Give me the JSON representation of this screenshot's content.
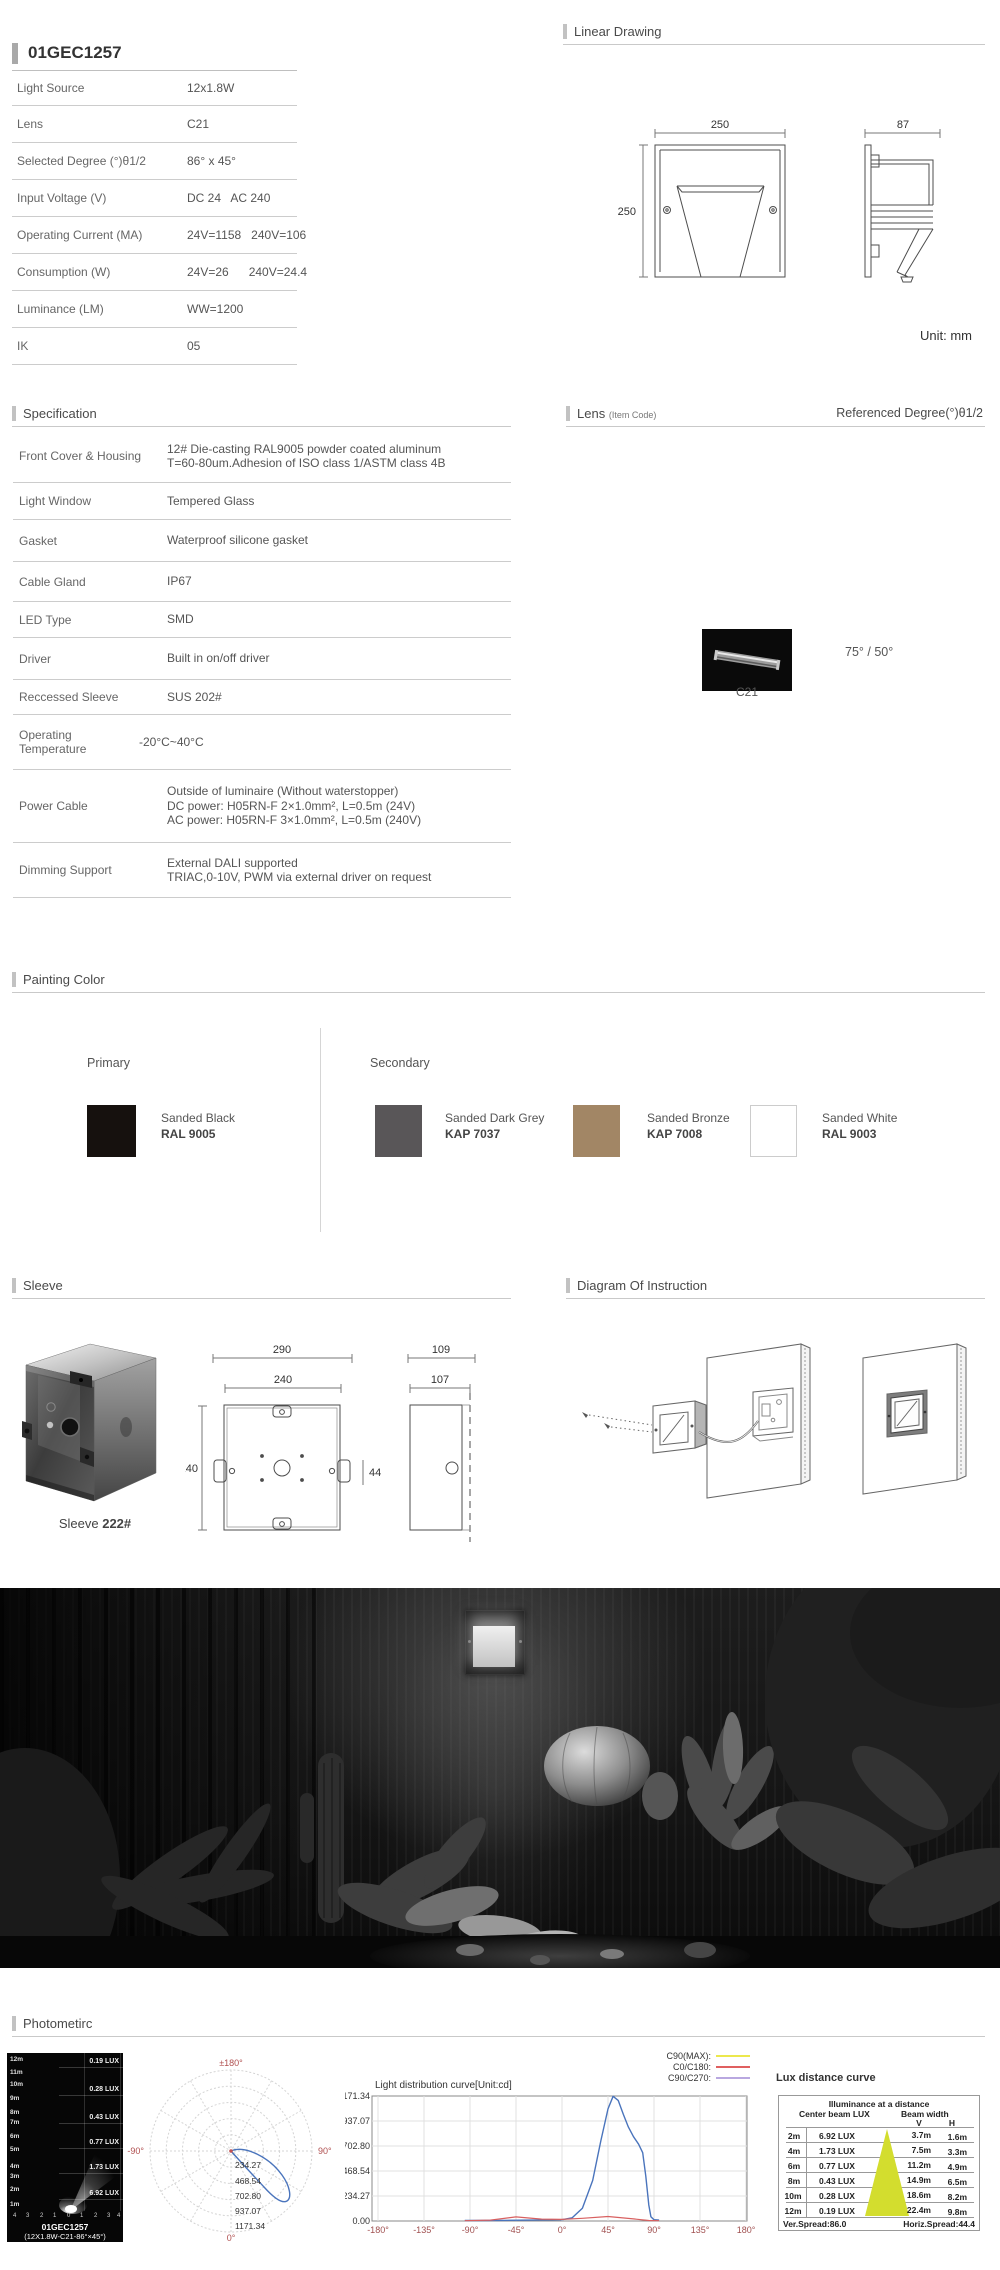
{
  "product": {
    "code": "01GEC1257",
    "rows": [
      {
        "label": "Light Source",
        "value": "12x1.8W"
      },
      {
        "label": "Lens",
        "value": "C21"
      },
      {
        "label": "Selected Degree (°)θ1/2",
        "value": "86° x 45°"
      },
      {
        "label": "Input Voltage (V)",
        "value": "DC 24   AC 240"
      },
      {
        "label": "Operating Current (MA)",
        "value": "24V=1158   240V=106"
      },
      {
        "label": "Consumption (W)",
        "value": "24V=26      240V=24.4"
      },
      {
        "label": "Luminance (LM)",
        "value": "WW=1200"
      },
      {
        "label": "IK",
        "value": "05"
      }
    ]
  },
  "linear_drawing": {
    "title": "Linear Drawing",
    "front_width": "250",
    "front_height": "250",
    "side_width": "87",
    "unit_note": "Unit: mm"
  },
  "specification": {
    "title": "Specification",
    "rows": [
      {
        "label": "Front Cover & Housing",
        "lines": [
          "12# Die-casting RAL9005 powder coated aluminum",
          "T=60-80um.Adhesion of ISO class 1/ASTM class 4B"
        ]
      },
      {
        "label": "Light Window",
        "lines": [
          "Tempered Glass"
        ]
      },
      {
        "label": "Gasket",
        "lines": [
          "Waterproof silicone gasket"
        ]
      },
      {
        "label": "Cable Gland",
        "lines": [
          "IP67"
        ]
      },
      {
        "label": "LED Type",
        "lines": [
          "SMD"
        ]
      },
      {
        "label": "Driver",
        "lines": [
          "Built in on/off driver"
        ]
      },
      {
        "label": "Reccessed Sleeve",
        "lines": [
          "SUS 202#"
        ]
      },
      {
        "label": "Operating Temperature",
        "lines": [
          "-20°C~40°C"
        ]
      },
      {
        "label": "Power Cable",
        "lines": [
          "Outside of luminaire (Without waterstopper)",
          "DC power: H05RN-F 2×1.0mm², L=0.5m (24V)",
          "AC power: H05RN-F 3×1.0mm², L=0.5m (240V)"
        ]
      },
      {
        "label": "Dimming Support",
        "lines": [
          "External DALI supported",
          "TRIAC,0-10V, PWM via external driver on request"
        ]
      }
    ]
  },
  "lens_section": {
    "title": "Lens",
    "subtitle": "(Item Code)",
    "right_title": "Referenced Degree(°)θ1/2",
    "item": "C21",
    "degree": "75° / 50°"
  },
  "painting": {
    "title": "Painting Color",
    "primary_label": "Primary",
    "secondary_label": "Secondary",
    "swatches": [
      {
        "name": "Sanded Black",
        "code": "RAL 9005",
        "color": "#16110e"
      },
      {
        "name": "Sanded Dark Grey",
        "code": "KAP 7037",
        "color": "#595658"
      },
      {
        "name": "Sanded Bronze",
        "code": "KAP 7008",
        "color": "#a28665"
      },
      {
        "name": "Sanded White",
        "code": "RAL 9003",
        "color": "#ffffff"
      }
    ]
  },
  "sleeve": {
    "title": "Sleeve",
    "caption": "Sleeve",
    "caption_code": "222#",
    "front_outer": "290",
    "front_inner": "240",
    "front_height": "240",
    "tab": "44",
    "side_outer": "109",
    "side_inner": "107"
  },
  "instruction": {
    "title": "Diagram Of Instruction"
  },
  "photometric": {
    "title": "Photometirc",
    "beam": {
      "distances": [
        "12m",
        "11m",
        "10m",
        "9m",
        "8m",
        "7m",
        "6m",
        "5m",
        "4m",
        "3m",
        "2m",
        "1m"
      ],
      "lux": [
        "0.19 LUX",
        "0.28 LUX",
        "0.43 LUX",
        "0.77 LUX",
        "1.73 LUX",
        "6.92 LUX"
      ],
      "axis": [
        "4",
        "3",
        "2",
        "1",
        "0",
        "1",
        "2",
        "3",
        "4"
      ],
      "caption1": "01GEC1257",
      "caption2": "(12X1.8W-C21-86°×45°)"
    },
    "polar": {
      "top": "±180°",
      "left": "-90°",
      "right": "90°",
      "bottom": "0°",
      "rings": [
        "234.27",
        "468.54",
        "702.80",
        "937.07",
        "1171.34"
      ]
    },
    "legend": [
      {
        "label": "C90(MAX):",
        "color": "#ece84e"
      },
      {
        "label": "C0/C180:",
        "color": "#e06060"
      },
      {
        "label": "C90/C270:",
        "color": "#b9a8e0"
      }
    ],
    "distribution": {
      "title": "Light distribution curve[Unit:cd]",
      "y_ticks": [
        "1171.34",
        "937.07",
        "702.80",
        "468.54",
        "234.27",
        "0.00"
      ],
      "x_ticks": [
        "-180°",
        "-135°",
        "-90°",
        "-45°",
        "0°",
        "45°",
        "90°",
        "135°",
        "180°"
      ]
    },
    "lux_table": {
      "title": "Lux distance curve",
      "header": "Illuminance at a distance",
      "col_left": "Center beam LUX",
      "col_right": "Beam width",
      "v": "V",
      "h": "H",
      "rows": [
        {
          "d": "2m",
          "lux": "6.92 LUX",
          "v": "3.7m",
          "h": "1.6m"
        },
        {
          "d": "4m",
          "lux": "1.73 LUX",
          "v": "7.5m",
          "h": "3.3m"
        },
        {
          "d": "6m",
          "lux": "0.77 LUX",
          "v": "11.2m",
          "h": "4.9m"
        },
        {
          "d": "8m",
          "lux": "0.43 LUX",
          "v": "14.9m",
          "h": "6.5m"
        },
        {
          "d": "10m",
          "lux": "0.28 LUX",
          "v": "18.6m",
          "h": "8.2m"
        },
        {
          "d": "12m",
          "lux": "0.19 LUX",
          "v": "22.4m",
          "h": "9.8m"
        }
      ],
      "footer_left": "Ver.Spread:86.0",
      "footer_right": "Horiz.Spread:44.4"
    }
  },
  "chart_data": [
    {
      "type": "line",
      "title": "Light distribution curve[Unit:cd]",
      "xlabel": "angle",
      "ylabel": "cd",
      "xlim": [
        -180,
        180
      ],
      "ylim": [
        0,
        1171.34
      ],
      "y_ticks": [
        0,
        234.27,
        468.54,
        702.8,
        937.07,
        1171.34
      ],
      "x_ticks": [
        -180,
        -135,
        -90,
        -45,
        0,
        45,
        90,
        135,
        180
      ],
      "legend_position": "top-right",
      "grid": true,
      "series": [
        {
          "name": "C90(MAX)",
          "color": "#ece84e",
          "x": [],
          "y": []
        },
        {
          "name": "C0/C180",
          "color": "#e06060",
          "x": [
            -95,
            -70,
            -45,
            -20,
            0,
            20,
            45,
            70,
            85,
            95
          ],
          "y": [
            3,
            8,
            38,
            18,
            15,
            25,
            42,
            20,
            5,
            3
          ]
        },
        {
          "name": "C90/C270",
          "color": "#4a74bc",
          "x": [
            -95,
            -45,
            0,
            10,
            20,
            30,
            38,
            45,
            50,
            55,
            60,
            65,
            70,
            75,
            80,
            85,
            90,
            95
          ],
          "y": [
            5,
            8,
            12,
            30,
            120,
            380,
            750,
            1050,
            1171,
            1130,
            1000,
            880,
            790,
            720,
            520,
            150,
            12,
            8
          ]
        }
      ]
    },
    {
      "type": "line",
      "subtype": "polar",
      "title": "Polar intensity diagram",
      "rings_cd": [
        234.27,
        468.54,
        702.8,
        937.07,
        1171.34
      ],
      "angle_labels": [
        "±180°",
        "-90°",
        "90°",
        "0°"
      ],
      "peak_angle_deg": 50,
      "peak_cd": 1171.34
    },
    {
      "type": "table",
      "title": "Lux distance curve",
      "categories": [
        "2m",
        "4m",
        "6m",
        "8m",
        "10m",
        "12m"
      ],
      "series": [
        {
          "name": "Center beam LUX",
          "values": [
            6.92,
            1.73,
            0.77,
            0.43,
            0.28,
            0.19
          ]
        },
        {
          "name": "Beam width V (m)",
          "values": [
            3.7,
            7.5,
            11.2,
            14.9,
            18.6,
            22.4
          ]
        },
        {
          "name": "Beam width H (m)",
          "values": [
            1.6,
            3.3,
            4.9,
            6.5,
            8.2,
            9.8
          ]
        }
      ],
      "ver_spread": 86.0,
      "horiz_spread": 44.4
    }
  ]
}
